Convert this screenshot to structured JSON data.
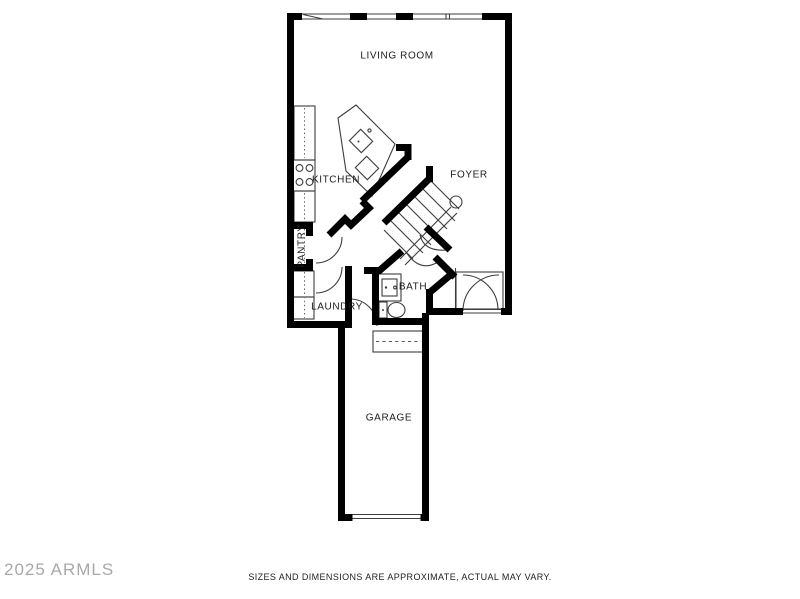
{
  "page": {
    "background": "#ffffff"
  },
  "watermark": {
    "text": "2025 ARMLS",
    "color": "#9a9a9a"
  },
  "disclaimer": {
    "text": "SIZES AND DIMENSIONS ARE APPROXIMATE, ACTUAL MAY VARY.",
    "color": "#222222"
  },
  "floorplan": {
    "wall_color": "#000000",
    "line_color": "#3d3d3d",
    "rooms": [
      {
        "id": "living-room",
        "label": "LIVING ROOM"
      },
      {
        "id": "kitchen",
        "label": "KITCHEN"
      },
      {
        "id": "foyer",
        "label": "FOYER"
      },
      {
        "id": "pantry",
        "label": "PANTRY"
      },
      {
        "id": "bath",
        "label": "BATH"
      },
      {
        "id": "laundry",
        "label": "LAUNDRY"
      },
      {
        "id": "garage",
        "label": "GARAGE"
      }
    ],
    "fixtures": [
      "kitchen-counter",
      "stove",
      "kitchen-island",
      "island-sink",
      "dishwasher",
      "washer",
      "dryer",
      "bath-vanity",
      "toilet",
      "staircase",
      "stair-railing",
      "garage-door",
      "front-door",
      "windows"
    ]
  }
}
